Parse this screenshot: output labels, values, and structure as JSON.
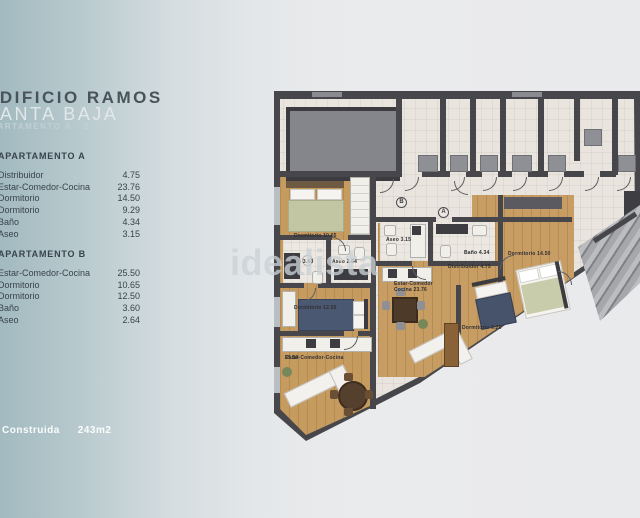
{
  "header": {
    "building": "EDIFICIO RAMOS",
    "floor": "PLANTA BAJA",
    "subtitle": "APARTAMENTO A - B"
  },
  "apartment_a": {
    "title": "APARTAMENTO A",
    "rooms": [
      {
        "name": "Distribuidor",
        "area": "4.75"
      },
      {
        "name": "Estar-Comedor-Cocina",
        "area": "23.76"
      },
      {
        "name": "Dormitorio",
        "area": "14.50"
      },
      {
        "name": "Dormitorio",
        "area": "9.29"
      },
      {
        "name": "Baño",
        "area": "4.34"
      },
      {
        "name": "Aseo",
        "area": "3.15"
      }
    ]
  },
  "apartment_b": {
    "title": "APARTAMENTO B",
    "rooms": [
      {
        "name": "Estar-Comedor-Cocina",
        "area": "25.50"
      },
      {
        "name": "Dormitorio",
        "area": "10.65"
      },
      {
        "name": "Dormitorio",
        "area": "12.50"
      },
      {
        "name": "Baño",
        "area": "3.60"
      },
      {
        "name": "Aseo",
        "area": "2.64"
      }
    ]
  },
  "footer": {
    "label": "Construida",
    "value": "243m2"
  },
  "watermark": "idealista",
  "plan": {
    "markers": {
      "a": "A",
      "b": "B"
    },
    "labels": {
      "dorm_b1": "Dormitorio 10.65",
      "bano_b": "Baño 3.60",
      "aseo_b": "Aseo 2.64",
      "dorm_b2": "Dormitorio 12.50",
      "estar_b_name": "Estar-Comedor-Cocina",
      "estar_b_area": "25.50",
      "aseo_a": "Aseo 3.15",
      "bano_a": "Baño 4.34",
      "distribuidor_a": "Distribuidor 4.75",
      "estar_a_line1": "Estar-Comedor",
      "estar_a_line2": "Cocina 23.76",
      "dorm_a1": "Dormitorio 14.50",
      "dorm_a2": "Dormitorio 9.29"
    }
  }
}
